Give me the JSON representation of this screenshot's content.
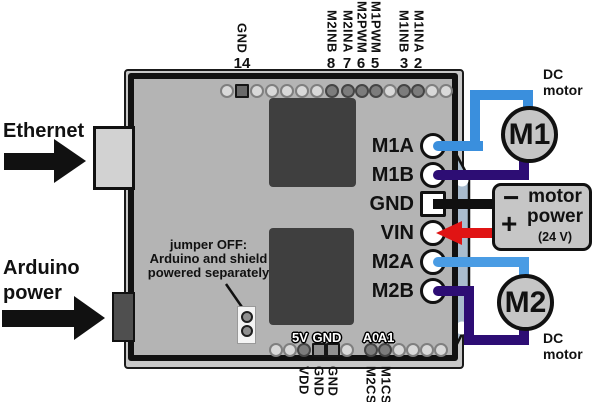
{
  "left_annotations": {
    "ethernet_label": "Ethernet",
    "arduino_power_line1": "Arduino",
    "arduino_power_line2": "power"
  },
  "board": {
    "top_header": {
      "labels": [
        {
          "name": "GND",
          "pin": "14"
        },
        {
          "name": "M2INB",
          "pin": "8"
        },
        {
          "name": "M2INA",
          "pin": "7"
        },
        {
          "name": "M2PWM",
          "pin": "6"
        },
        {
          "name": "M1PWM",
          "pin": "5"
        },
        {
          "name": "M1INB",
          "pin": "3"
        },
        {
          "name": "M1INA",
          "pin": "2"
        }
      ]
    },
    "right_terminals": [
      "M1A",
      "M1B",
      "GND",
      "VIN",
      "M2A",
      "M2B"
    ],
    "silkscreen": {
      "s5v": "5V",
      "gnd": "GND",
      "a0": "A0",
      "a1": "A1"
    },
    "bottom_header": {
      "labels": [
        "VDD",
        "GND",
        "GND",
        "M2CS",
        "M1CS"
      ]
    },
    "jumper_note": {
      "line1": "jumper OFF:",
      "line2": "Arduino and shield",
      "line3": "powered separately"
    }
  },
  "right_annotations": {
    "m1_motor": {
      "label": "M1",
      "caption_line1": "DC",
      "caption_line2": "motor"
    },
    "m2_motor": {
      "label": "M2",
      "caption_line1": "DC",
      "caption_line2": "motor"
    },
    "power_supply": {
      "minus": "−",
      "plus": "+",
      "line1": "motor",
      "line2": "power",
      "line3": "(24 V)"
    }
  },
  "colors": {
    "board_fill": "#b4b4b4",
    "chip_fill": "#3f3f3f",
    "wire_m1_blue": "#3a8fdd",
    "wire_m2_blue": "#4a9ce4",
    "wire_purple": "#2d0d74",
    "wire_red": "#e01414",
    "wire_black": "#101010",
    "terminal_strip": "#a9bcce",
    "motor_fill": "#c6c6c6"
  }
}
